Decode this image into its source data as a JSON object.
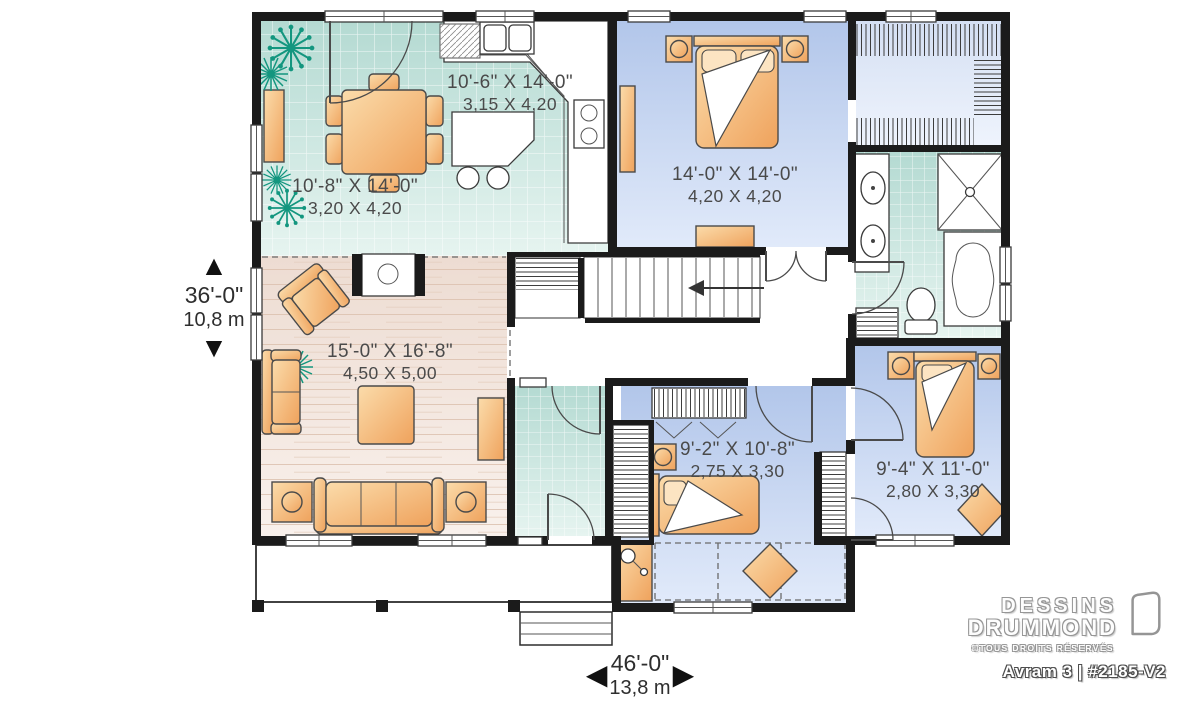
{
  "title": "Avram 3 floor plan",
  "branding": {
    "name_line1": "DESSINS",
    "name_line2": "DRUMMOND",
    "rights": "©TOUS DROITS RÉSERVÉS",
    "plan_id": "Avram 3 | #2185-V2"
  },
  "overall_dimensions": {
    "depth": {
      "imperial": "36'-0\"",
      "metric": "10,8 m"
    },
    "width": {
      "imperial": "46'-0\"",
      "metric": "13,8 m"
    }
  },
  "rooms": {
    "dining": {
      "imperial": "10'-8\" X 14'-0\"",
      "metric": "3,20 X 4,20"
    },
    "kitchen": {
      "imperial": "10'-6\" X 14'-0\"",
      "metric": "3,15 X 4,20"
    },
    "master_bedroom": {
      "imperial": "14'-0\" X 14'-0\"",
      "metric": "4,20 X 4,20"
    },
    "living": {
      "imperial": "15'-0\" X 16'-8\"",
      "metric": "4,50 X 5,00"
    },
    "bedroom_2": {
      "imperial": "9'-2\" X 10'-8\"",
      "metric": "2,75 X 3,30"
    },
    "bedroom_3": {
      "imperial": "9'-4\" X 11'-0\"",
      "metric": "2,80 X 3,30"
    }
  },
  "icons": {
    "dim_up": "▲",
    "dim_down": "▼",
    "dim_left": "◀",
    "dim_right": "▶"
  },
  "colors": {
    "wall": "#1b1b1b",
    "tile_teal": "#cbe6e0",
    "bedroom_blue": "#c2d3ee",
    "living_beige": "#f4e9e2",
    "furniture_orange": "#f5bc80",
    "plant_teal": "#13967f",
    "label_gray": "#4a4a4a"
  }
}
